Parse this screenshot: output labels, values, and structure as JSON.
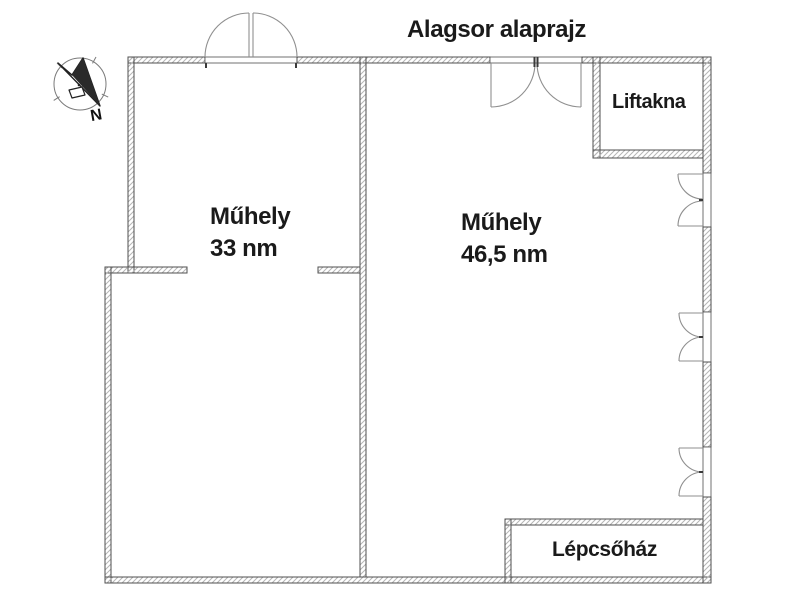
{
  "title": "Alagsor alaprajz",
  "compass": {
    "north_label": "N"
  },
  "rooms": {
    "workshop_left": {
      "name": "Műhely",
      "area": "33 nm"
    },
    "workshop_right": {
      "name": "Műhely",
      "area": "46,5 nm"
    },
    "elevator_shaft": {
      "name": "Liftakna"
    },
    "staircase": {
      "name": "Lépcsőház"
    }
  },
  "colors": {
    "background": "#ffffff",
    "wall_outline": "#4f4f4f",
    "wall_hatch": "#b5b5b5",
    "door_line": "#8f8f8f",
    "text": "#1a1a1a"
  }
}
